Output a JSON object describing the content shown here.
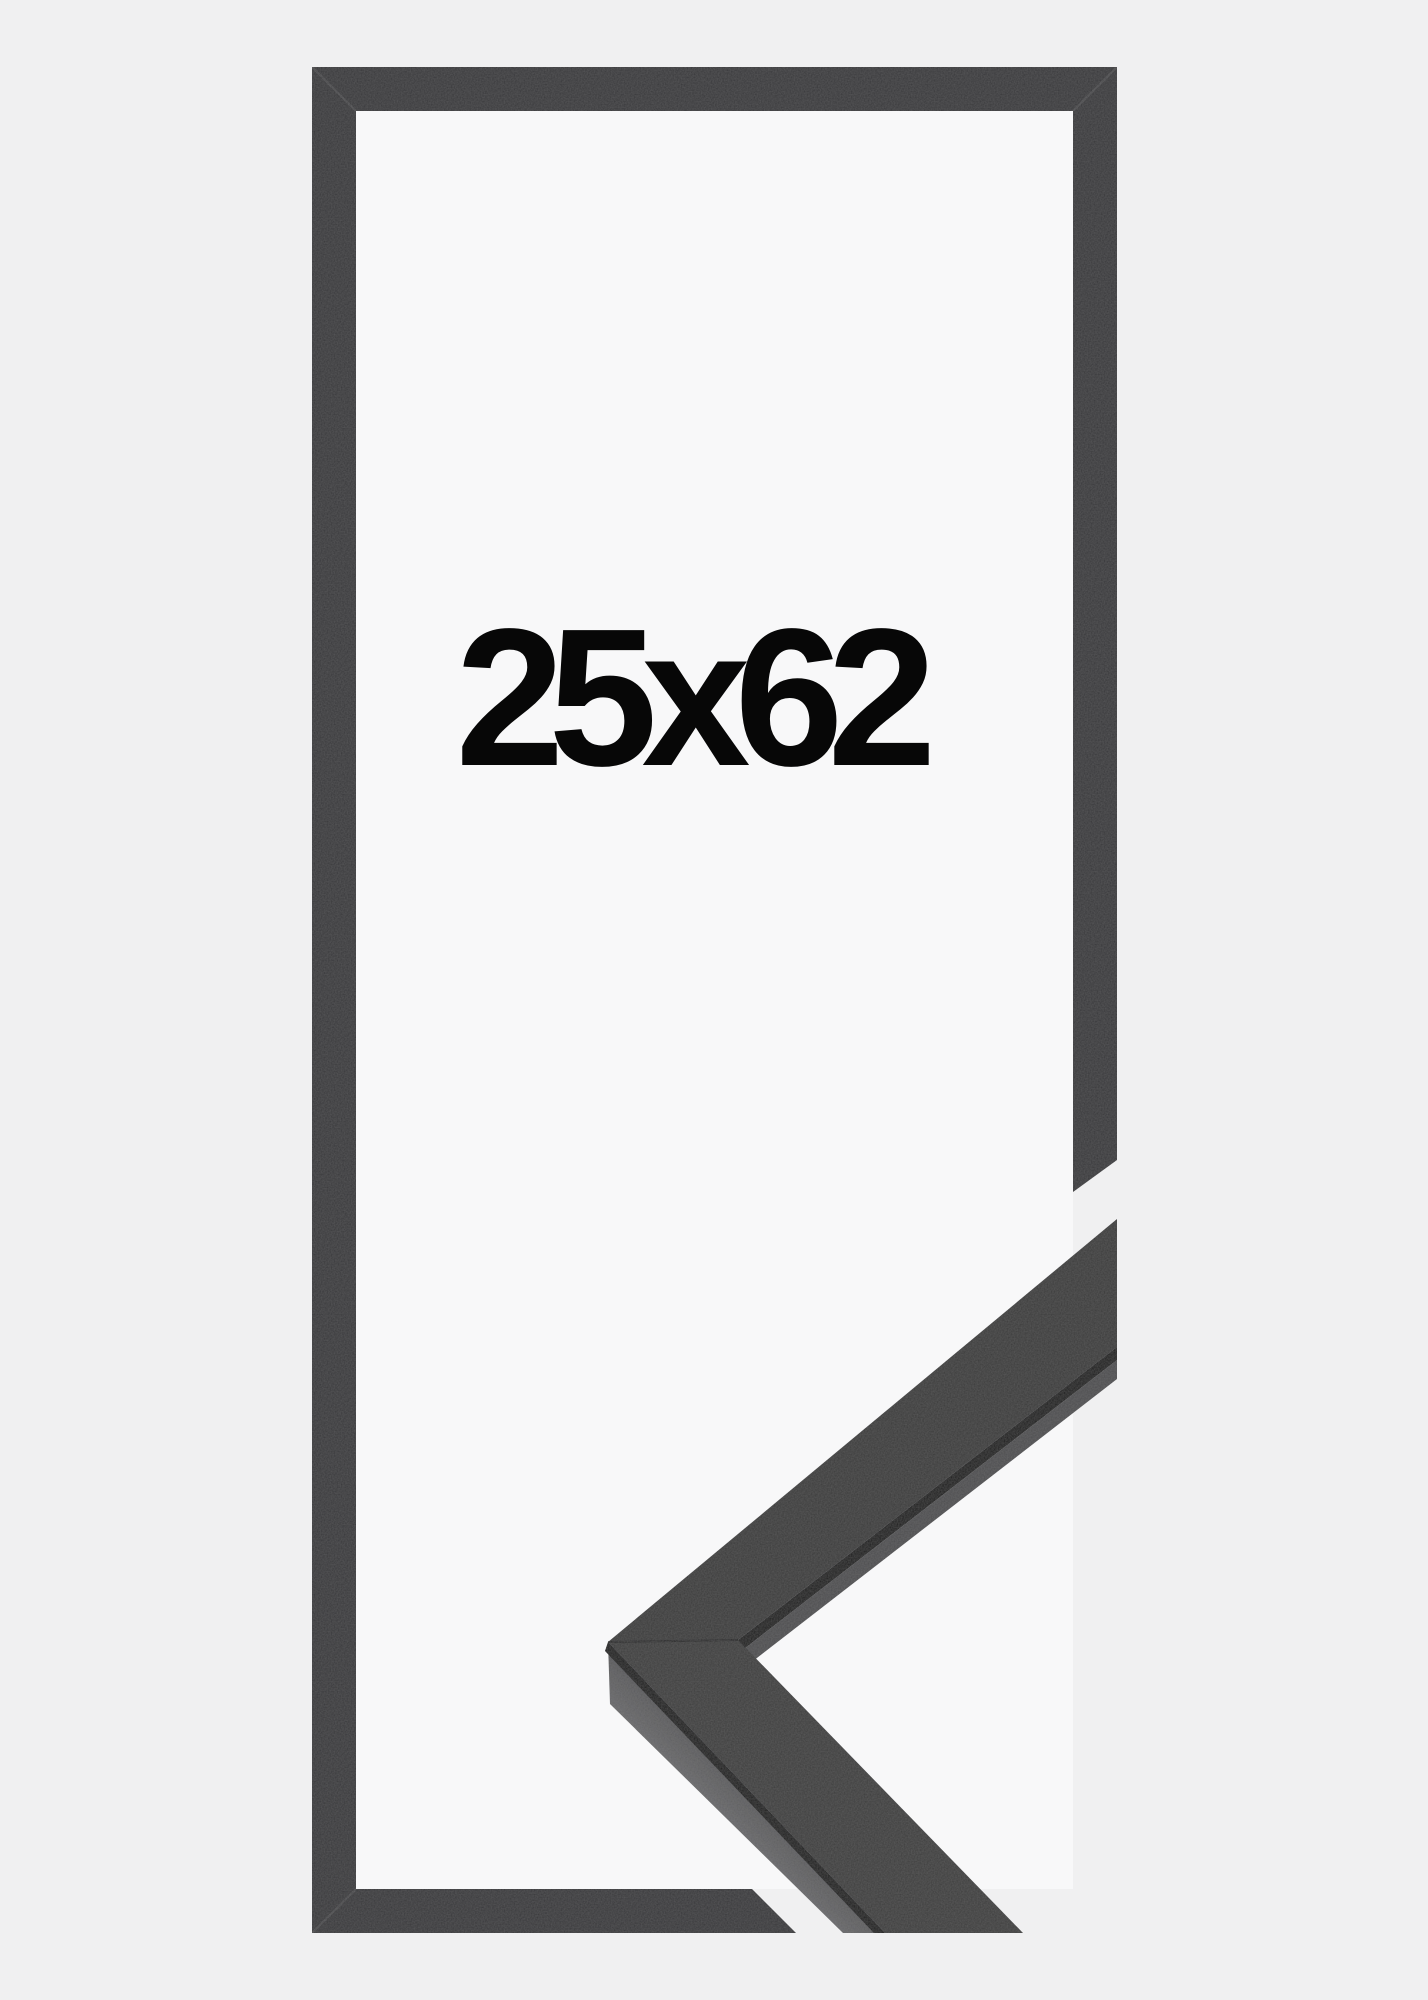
{
  "product": {
    "size_label": "25x62"
  },
  "colors": {
    "background": "#f0f0f1",
    "interior": "#f8f8f9",
    "frame": "#39393b",
    "text": "#070707",
    "sample_face": "#3a3a3b",
    "sample_face_bottom": "#3c3c3d",
    "sample_edge": "#4d4d4f",
    "sample_side_dark": "#4a4a4c",
    "sample_side_light": "#6e6e70",
    "seam": "#1a1a1b",
    "miter_crease": "#ffffff"
  }
}
